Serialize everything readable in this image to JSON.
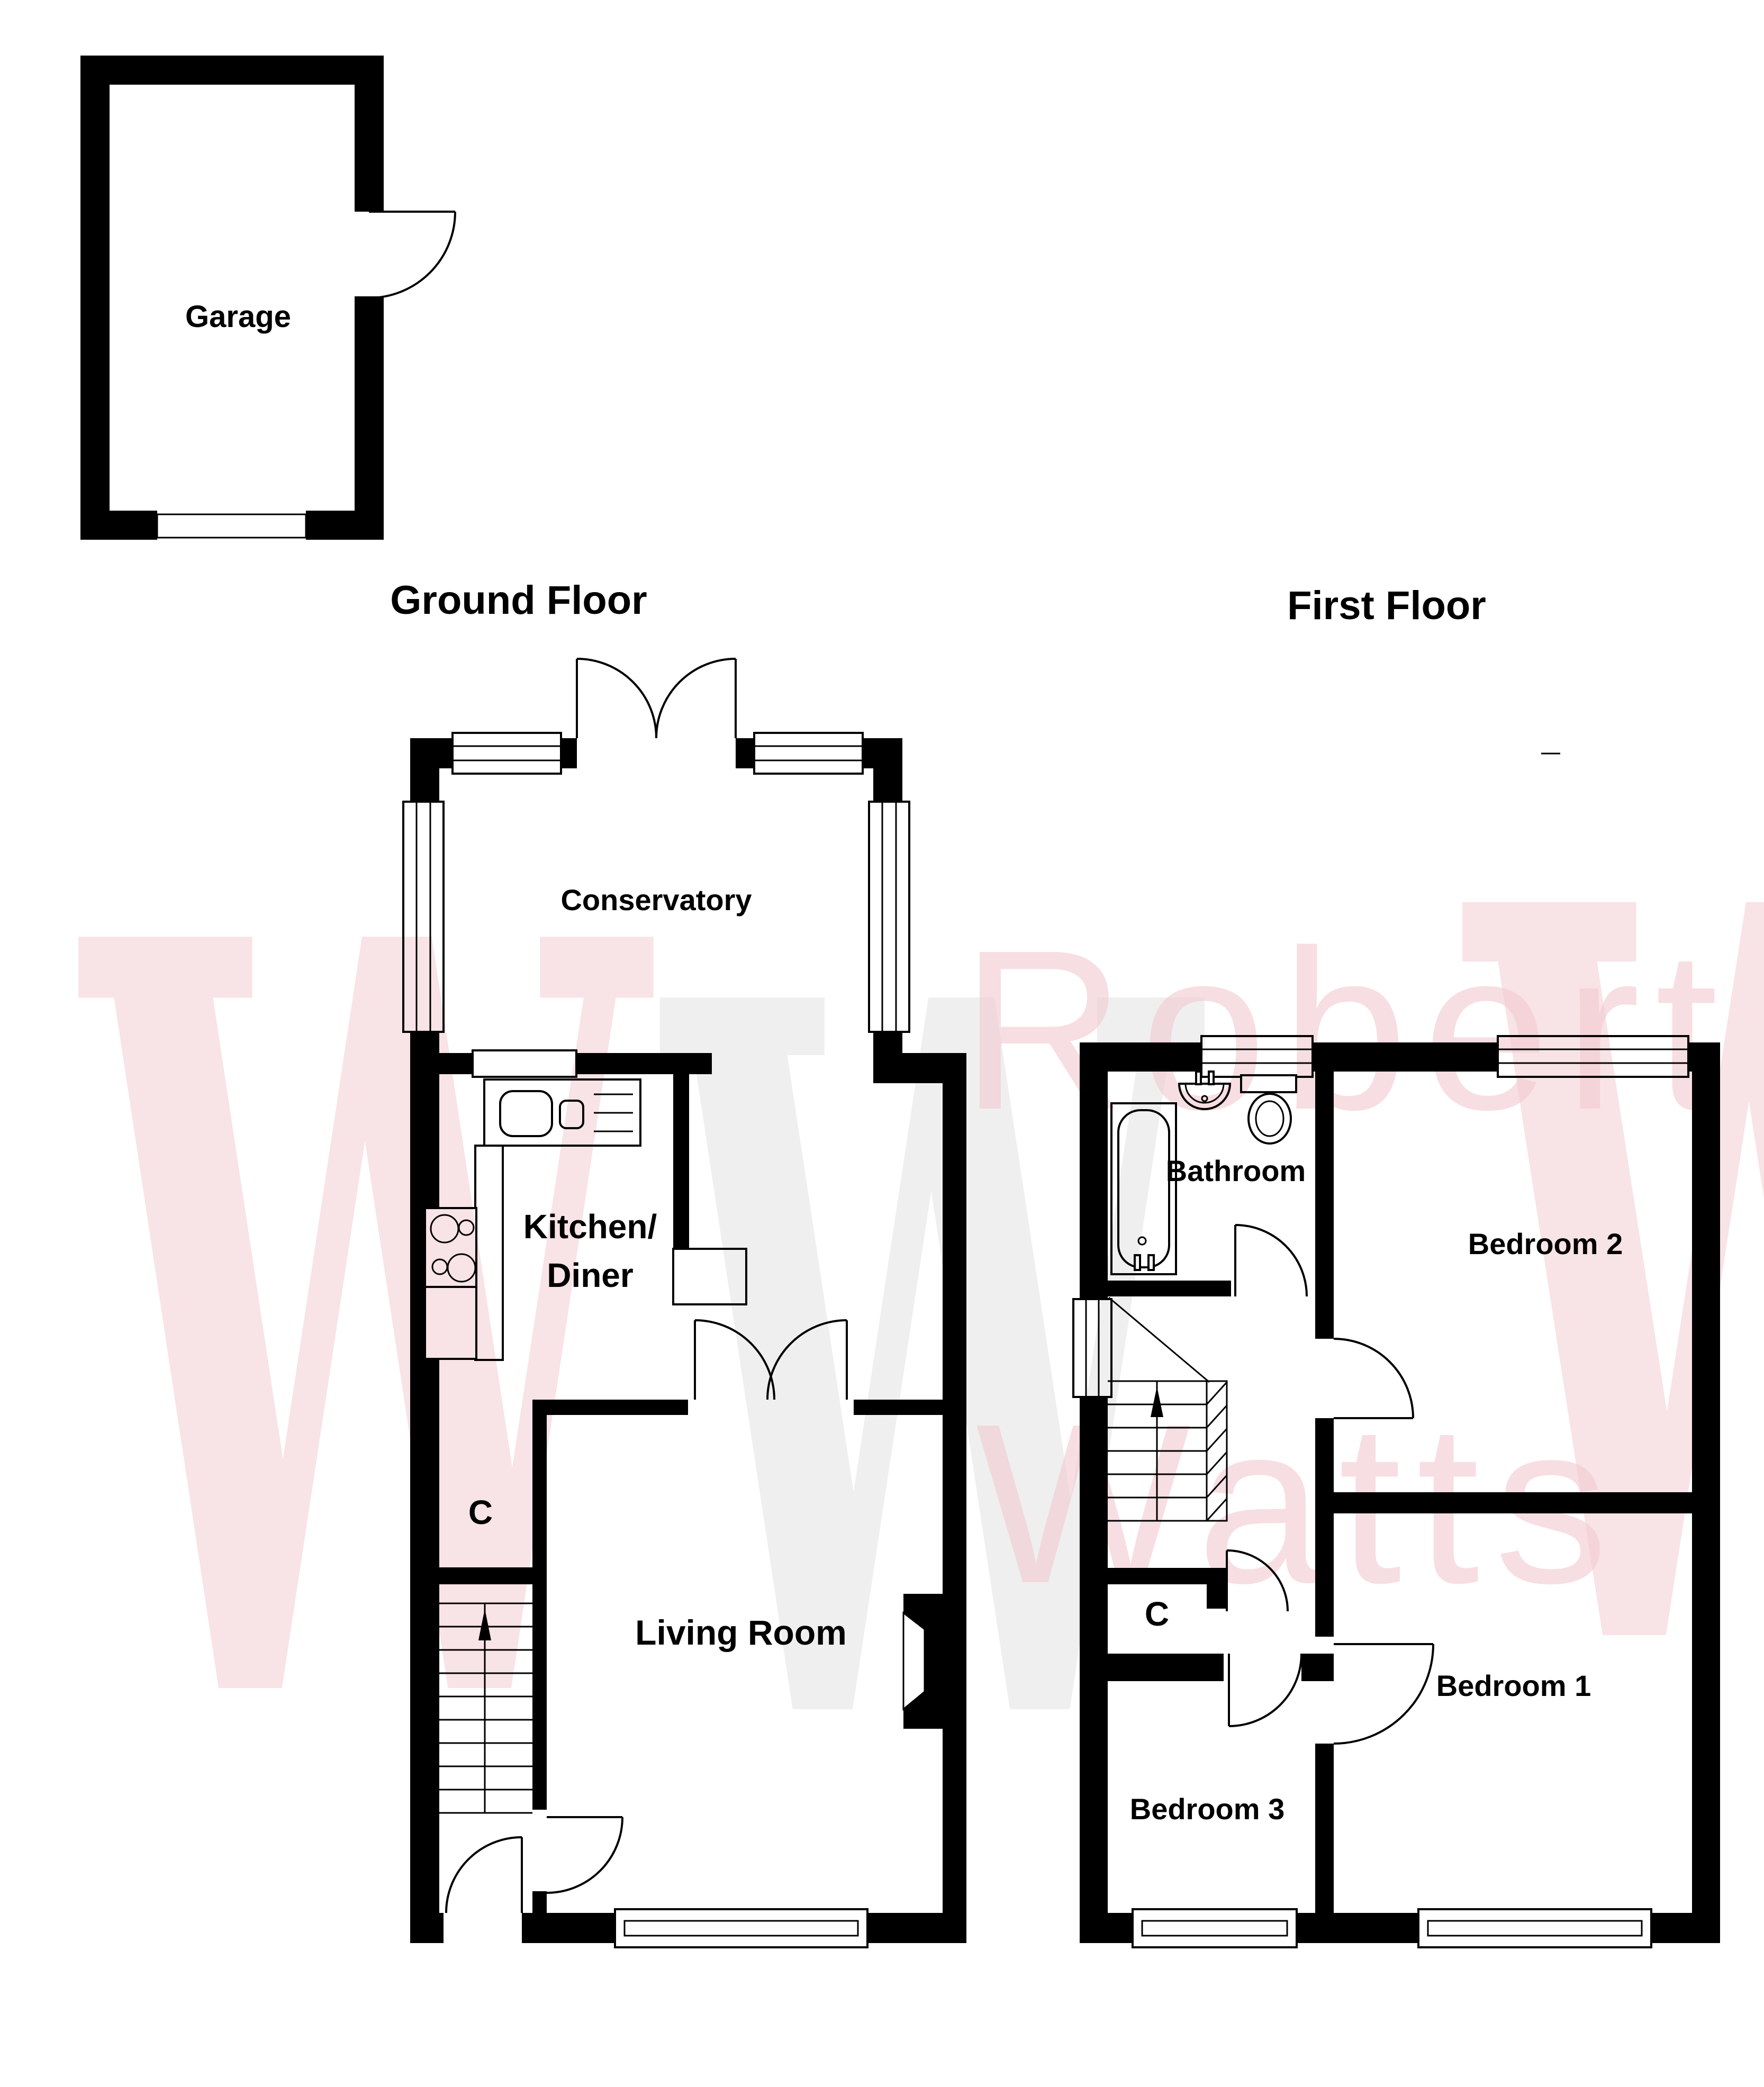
{
  "titles": {
    "ground_floor": "Ground Floor",
    "first_floor": "First Floor"
  },
  "garage": {
    "label": "Garage"
  },
  "ground_floor_rooms": {
    "conservatory": "Conservatory",
    "kitchen_line1": "Kitchen/",
    "kitchen_line2": "Diner",
    "living_room": "Living Room",
    "cupboard": "C"
  },
  "first_floor_rooms": {
    "bathroom": "Bathroom",
    "bedroom1": "Bedroom 1",
    "bedroom2": "Bedroom 2",
    "bedroom3": "Bedroom 3",
    "cupboard": "C"
  },
  "watermark": {
    "monogram": "W",
    "name_line1": "Robert",
    "name_line2": "Watts",
    "pink": "#f2c7ce",
    "gray": "#e9e9e9"
  },
  "colors": {
    "walls": "#000000",
    "background": "#ffffff"
  }
}
